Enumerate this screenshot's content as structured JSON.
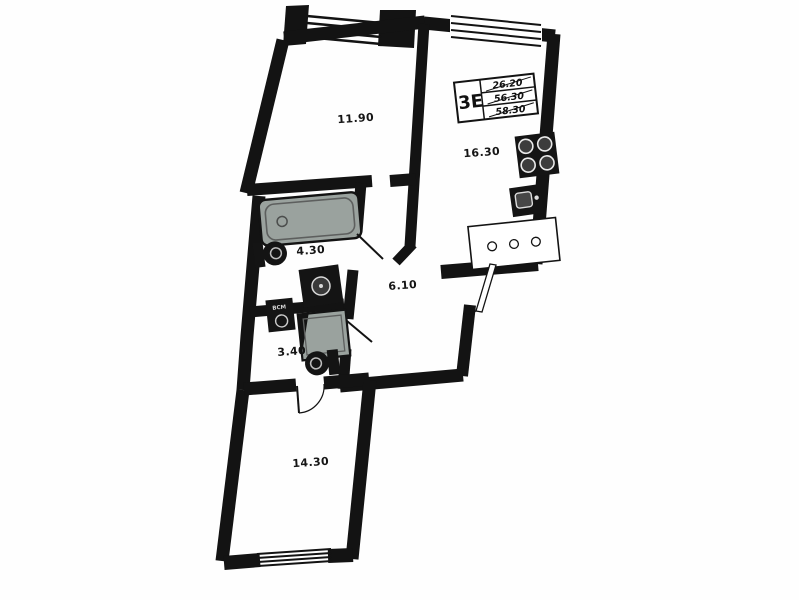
{
  "plan": {
    "type": "apartment-floor-plan",
    "rotation_note": "plan scanned with slight clockwise tilt",
    "colors": {
      "wall": "#131313",
      "fixture_dark": "#141414",
      "wet_zone_fill": "#9aa29e",
      "background": "#fefefe",
      "label": "#151515"
    },
    "title_block": {
      "layout_code": "3Е",
      "area_rows": [
        "26.20",
        "56.30",
        "58.30"
      ]
    },
    "rooms": [
      {
        "name": "living-room-1",
        "label": "11.90"
      },
      {
        "name": "kitchen-living",
        "label": "16.30"
      },
      {
        "name": "bathroom",
        "label": "4.30"
      },
      {
        "name": "hallway",
        "label": "6.10"
      },
      {
        "name": "wc",
        "label": "3.40"
      },
      {
        "name": "living-room-2",
        "label": "14.30"
      }
    ],
    "riser_label": "ВСМ",
    "fixtures": [
      "balcony-glazing",
      "kitchen-window",
      "stove",
      "kitchen-sink",
      "kitchen-counter",
      "bathtub",
      "toilet",
      "washbasin",
      "utility-riser",
      "shower-tray",
      "toilet-2",
      "entrance-door",
      "interior-door-leaves",
      "bottom-window"
    ]
  }
}
